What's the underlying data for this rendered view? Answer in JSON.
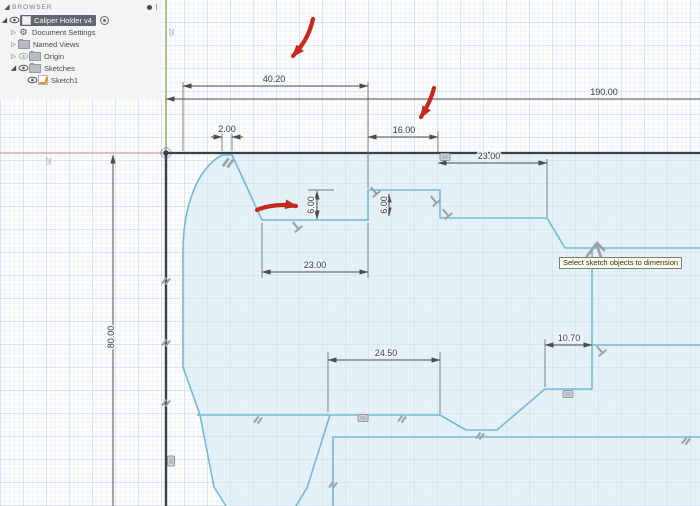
{
  "browser": {
    "header": "BROWSER",
    "items": [
      {
        "label": "Caliper Holder v4",
        "icon": "component-cube-icon",
        "selected": true
      },
      {
        "label": "Document Settings",
        "icon": "gear-icon"
      },
      {
        "label": "Named Views",
        "icon": "folder-icon"
      },
      {
        "label": "Origin",
        "icon": "folder-icon"
      },
      {
        "label": "Sketches",
        "icon": "folder-icon"
      },
      {
        "label": "Sketch1",
        "icon": "sketch-icon"
      }
    ]
  },
  "canvas": {
    "tooltip": "Select sketch objects to dimension",
    "grid_labels": {
      "top": "25",
      "left": "25"
    },
    "dimensions": {
      "d40_20": "40.20",
      "d190": "190.00",
      "d2": "2.00",
      "d16": "16.00",
      "d23_top": "23.00",
      "d6_a": "6.00",
      "d6_b": "6.00",
      "d23_bottom": "23.00",
      "d24_50": "24.50",
      "d10_70": "10.70",
      "d80": "80.00"
    },
    "colors": {
      "sketch_line": "#74b9d6",
      "profile_fill": "#d3e9f4",
      "fixed_line": "#3b4044",
      "axis_x": "#d8a8a8",
      "axis_y": "#a6c48c",
      "dimension": "#3c3c3c",
      "annotation_red": "#c5281c",
      "constraint_gray": "#9aa0a5"
    }
  }
}
